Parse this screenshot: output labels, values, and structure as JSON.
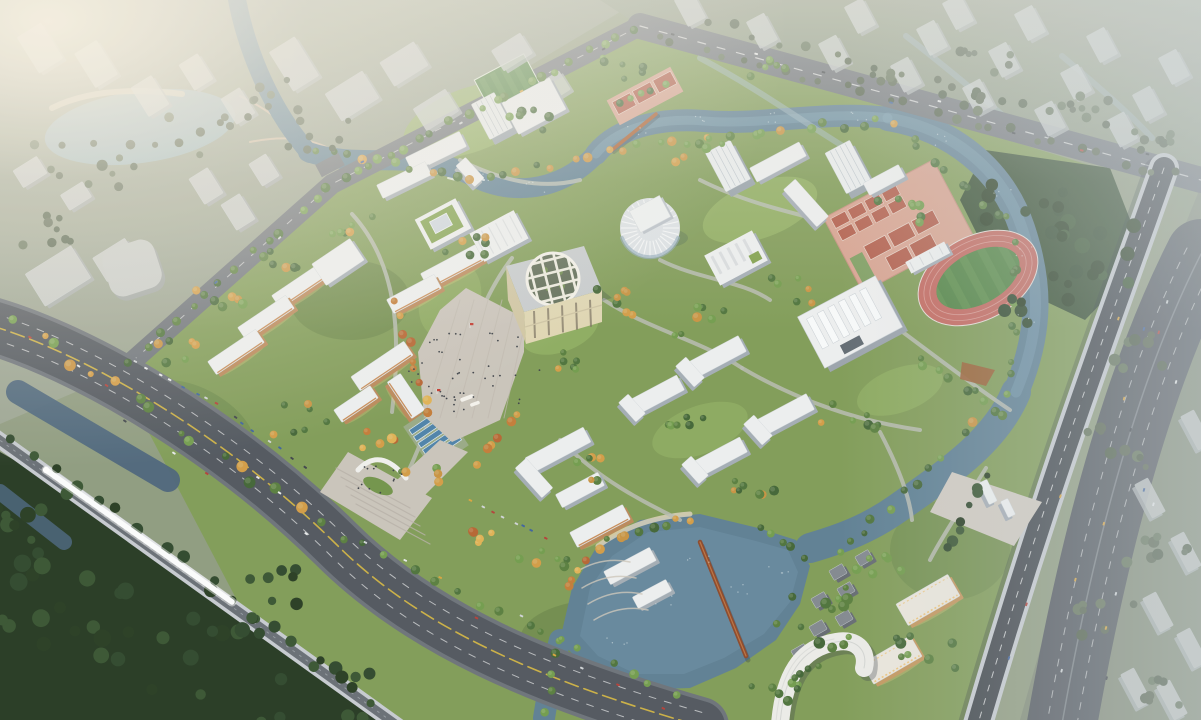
{
  "meta": {
    "domain": "Natural-Image",
    "subject": "aerial-birdseye-rendering-university-campus-masterplan",
    "time_of_day": "hazy-dusk-warm-sun-from-left",
    "canvas_w": 1201,
    "canvas_h": 720
  },
  "palette": {
    "land": "#8d9a7e",
    "cityGroundTL": "#9aa391",
    "cityGroundTR": "#8e9a85",
    "cityGroundR": "#7f8a76",
    "campusGreen": "#7e9a55",
    "lawnLight": "#93b263",
    "lawnShade": "#5d7b41",
    "forest": "#30492c",
    "forestDark": "#22361f",
    "water": "#5b7d92",
    "waterLight": "#7fa6bb",
    "waterDark": "#46617a",
    "pond": "#9db7bf",
    "sand": "#d9d0bb",
    "roadDark": "#4e545c",
    "roadMid": "#6a7078",
    "roadLight": "#9aa0a6",
    "concrete": "#c6cad0",
    "deckDark": "#3e444b",
    "laneWhite": "#e8eaec",
    "laneYellow": "#d8b83f",
    "plaza": "#c9c3ba",
    "plazaLine": "#bdb7ae",
    "roofWhite": "#edeff0",
    "wallShadow": "#a2abb4",
    "towerSide": "#97a1ab",
    "warmSide": "#b98657",
    "warmAccent": "#c07a3e",
    "cream": "#dfd5b2",
    "creamDark": "#cfc5a2",
    "cityTop": "#c8ccca",
    "citySide": "#a7adad",
    "hazyTop": "#ccd1d2",
    "hazySide": "#afb6b8",
    "litWall": "#c2955c",
    "litWindow": "#edc57e",
    "villaTop": "#80868e",
    "villaSide": "#62686f",
    "trackRed": "#c2655c",
    "trackLine": "#d8968f",
    "fieldGreen": "#4d8140",
    "fieldStripe": "#578a47",
    "courtBase": "#d7a18f",
    "courtRed": "#b15a48",
    "courtGreen": "#7b9c5e",
    "poolBlue": "#4a80a8",
    "greenRoof": "#7fa04b",
    "woodBridge": "#a85c2e",
    "rustBridge": "#8a4527",
    "train": "#fbfcfd",
    "glow": "#f7f0e2",
    "hazeTop": "#ebe9e1",
    "hazeRight": "#cdd5da",
    "people": "#3a3f46",
    "flagRed": "#c2372e",
    "carColors": [
      "#e8eaec",
      "#3c4148",
      "#b33c35",
      "#3a5f9e",
      "#d9a33c",
      "#cfd3d6"
    ]
  },
  "scene": {
    "landmarks": [
      "city-district-northwest",
      "city-park-pond",
      "city-district-northeast",
      "campus-grounds",
      "central-plaza",
      "central-cube-hall",
      "round-auditorium",
      "green-roof-library",
      "ribbed-auditorium",
      "gymnasium",
      "stadium-track",
      "tennis-basketball-courts",
      "small-soccer-field",
      "dormitory-cluster-west",
      "dormitory-cluster-north",
      "academic-quads",
      "main-gate",
      "east-gate",
      "solar-canopies",
      "campus-river",
      "campus-lake",
      "wood-footbridge-north",
      "rust-footbridge-south",
      "south-boulevard",
      "railway-viaduct",
      "high-speed-train",
      "elevated-expressway",
      "east-arterial-road",
      "southeast-residential",
      "curved-hotel-building",
      "forest-southwest",
      "forest-northeast"
    ]
  }
}
